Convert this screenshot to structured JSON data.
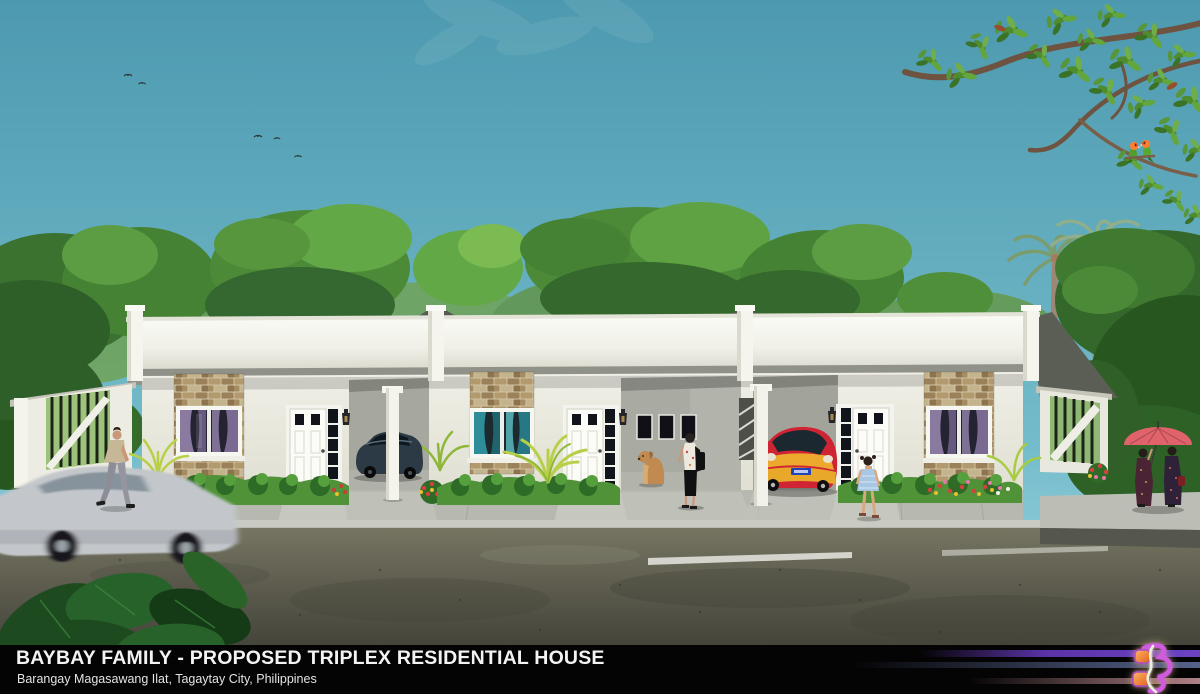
{
  "caption": {
    "title": "BAYBAY FAMILY - PROPOSED TRIPLEX RESIDENTIAL HOUSE",
    "subtitle": "Barangay Magasawang Ilat, Tagaytay City, Philippines"
  },
  "logo": {
    "monogram": "SB",
    "style": "glowing purple and orange calligraphic monogram"
  },
  "scene": {
    "type": "3D architectural exterior rendering",
    "subject": "single-storey flat-roof triplex residential house, front elevation",
    "units": 3,
    "figures": [
      "man walking past left fence",
      "woman with shoulder bag in middle carport",
      "golden dog sitting",
      "little girl in blue dress",
      "two women sharing a pink umbrella",
      "pair of lovebirds on overhanging branch",
      "small birds in sky"
    ],
    "vehicles": [
      "motion-blurred gray sedan passing in foreground",
      "dark sedan parked in left carport",
      "red and yellow sports car parked in right carport"
    ]
  },
  "colors": {
    "sky_top": "#4d99af",
    "sky_bottom": "#8fcbd8",
    "foliage_dark": "#2f5f28",
    "foliage_mid": "#4c8a38",
    "foliage_light": "#63a846",
    "fascia_white": "#f7f7f1",
    "wall_cream": "#ebebe0",
    "stone_tan": "#b59a6e",
    "grass_green": "#4f9238",
    "paving_gray": "#b7b9b1",
    "road_gray": "#6e6d5d",
    "caption_bg": "#040404",
    "caption_text": "#f3f3f3",
    "stripe_purple": "#5b33a8",
    "stripe_blue": "#55628c",
    "stripe_pink": "#b08187",
    "logo_orange": "#f08030",
    "logo_purple": "#cf5bdc",
    "umbrella_pink": "#e0636c",
    "sportscar_red": "#cf2433",
    "sportscar_yellow": "#eeb02e",
    "curtain_purple": "#8a7aa0",
    "curtain_teal": "#2f8d99"
  }
}
